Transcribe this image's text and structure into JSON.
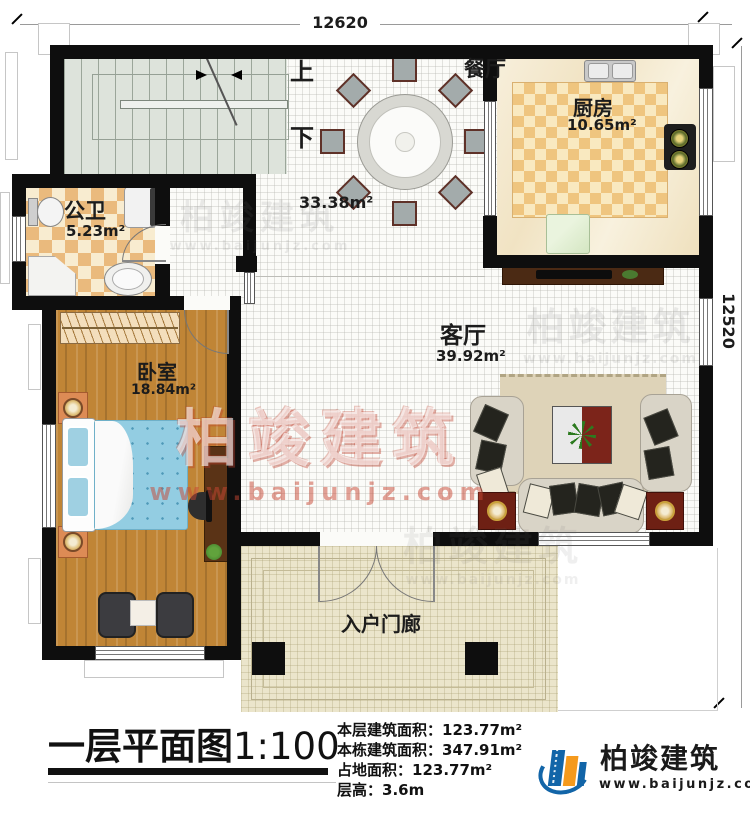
{
  "dims": {
    "top": "12620",
    "right": "12520"
  },
  "stairs": {
    "up": "上",
    "down": "下"
  },
  "rooms": {
    "dining": {
      "name": "餐厅",
      "area": "33.38m²"
    },
    "kitchen": {
      "name": "厨房",
      "area": "10.65m²"
    },
    "bath": {
      "name": "公卫",
      "area": "5.23m²"
    },
    "living": {
      "name": "客厅",
      "area": "39.92m²"
    },
    "bedroom": {
      "name": "卧室",
      "area": "18.84m²"
    },
    "porch": {
      "name": "入户门廊"
    }
  },
  "footer": {
    "title": "一层平面图",
    "scale": "1:100",
    "info": [
      {
        "label": "本层建筑面积：",
        "value": "123.77m²"
      },
      {
        "label": "本栋建筑面积：",
        "value": "347.91m²"
      },
      {
        "label": "占地面积：",
        "value": "123.77m²"
      },
      {
        "label": "层高：",
        "value": "3.6m"
      }
    ]
  },
  "brand": {
    "name": "柏竣建筑",
    "url": "www.baijunjz.com"
  },
  "watermark": {
    "name": "柏竣建筑",
    "url": "www.baijunjz.com"
  },
  "colors": {
    "wall": "#0e0e0e",
    "wood": "#c08536",
    "tile": "#eaba7d",
    "bed": "#93cde2",
    "brandBlue": "#1265a8",
    "brandOrange": "#f59a1d"
  }
}
